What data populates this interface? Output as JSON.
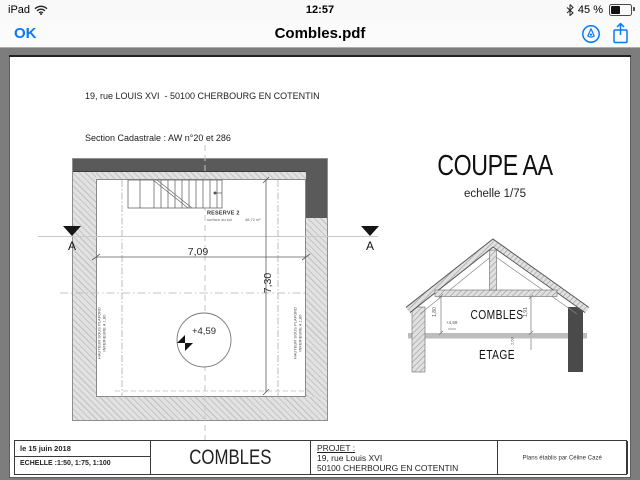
{
  "status_bar": {
    "device": "iPad",
    "time": "12:57",
    "battery_percent": "45 %"
  },
  "toolbar": {
    "back_label": "OK",
    "title": "Combles.pdf"
  },
  "pdf": {
    "header": {
      "line1": "19, rue LOUIS XVI  - 50100 CHERBOURG EN COTENTIN",
      "line2": "Section Cadastrale : AW n°20 et 286",
      "line3": "Superficie totale : 242 m²"
    },
    "plan": {
      "section_label": "A",
      "reserve_title": "RESERVE 2",
      "reserve_sub_left": "surface au sol",
      "reserve_sub_right": "48.72 m²",
      "dim_width": "7,09",
      "dim_depth": "7,30",
      "level": "+4,59",
      "note_line1": "HAUTEUR SOUS PLAFOND",
      "note_line2": "INFERIEURE A 1,80"
    },
    "coupe": {
      "title": "COUPE AA",
      "scale": "echelle 1/75",
      "room_attic": "COMBLES",
      "room_floor": "ETAGE",
      "dim_left": "1,80",
      "dim_right": "1,91",
      "level": "+4,59",
      "dim_below": "2,60"
    },
    "titleblock": {
      "date": "le 15 juin 2018",
      "scales": "ECHELLE :1:50, 1:75, 1:100",
      "sheet_title": "COMBLES",
      "project_label": "PROJET :",
      "project_address1": "19, rue Louis XVI",
      "project_address2": "50100 CHERBOURG EN COTENTIN",
      "credit": "Plans établis par Céline Cazé"
    }
  },
  "colors": {
    "accent": "#077af5",
    "canvas": "#7d7d7d"
  }
}
